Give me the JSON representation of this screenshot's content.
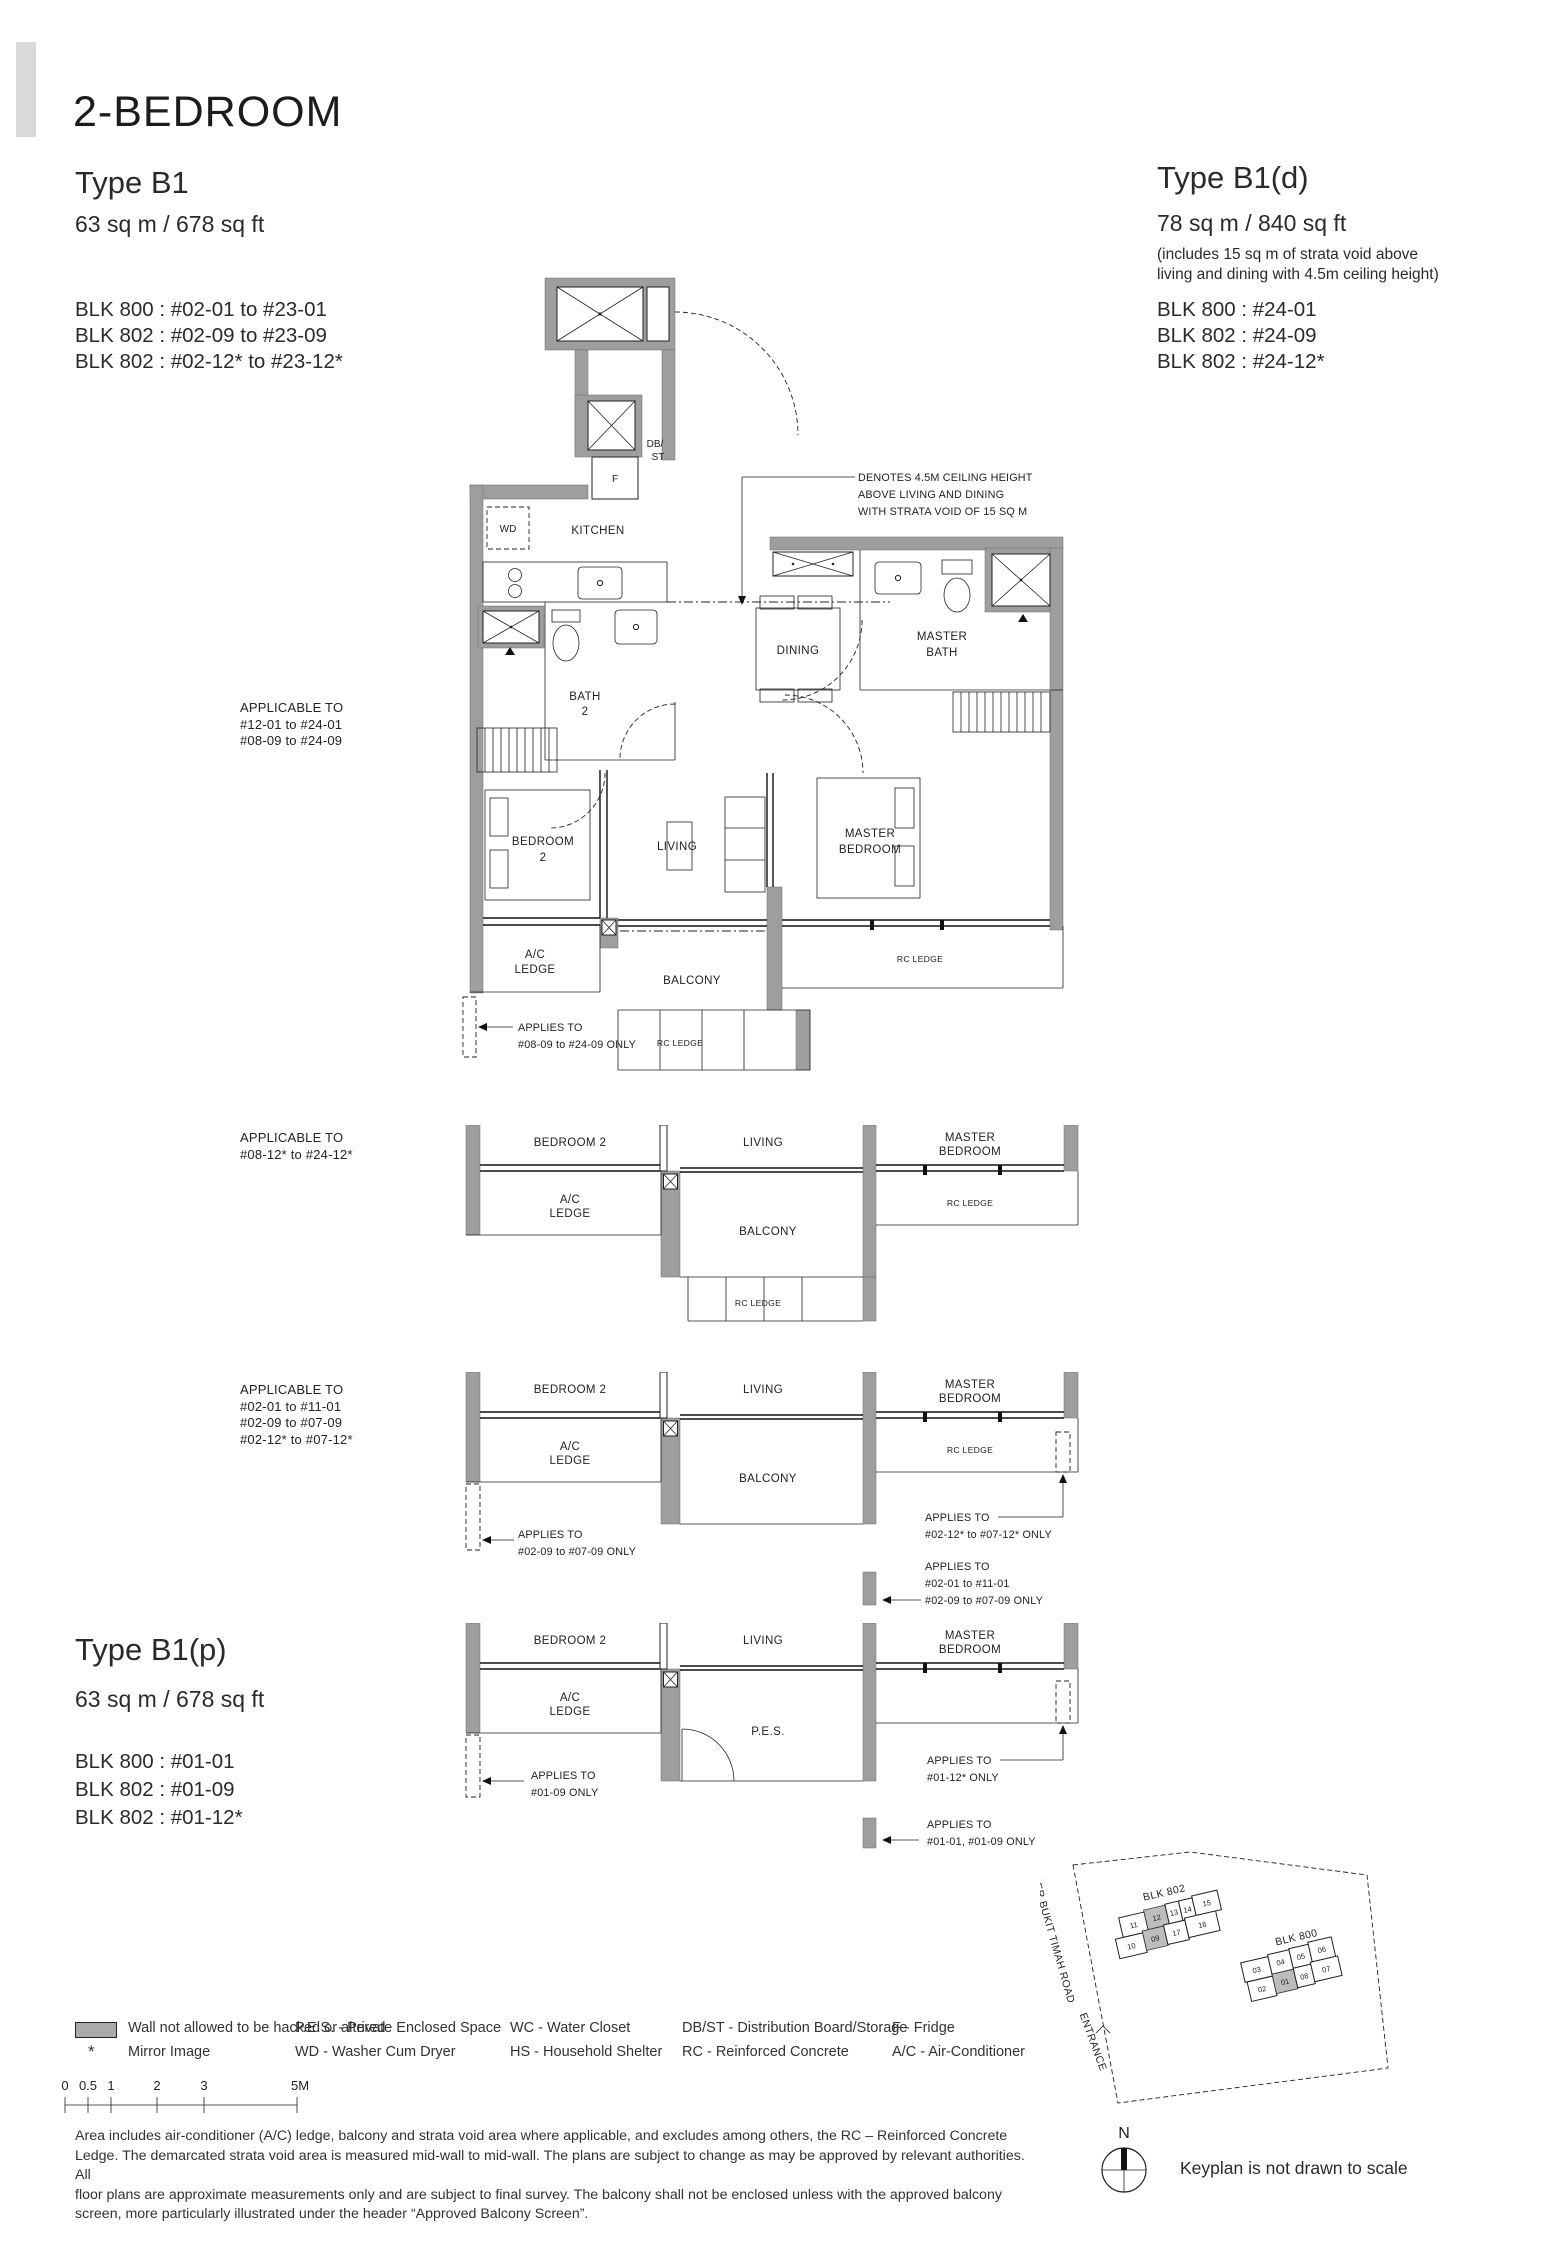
{
  "header": {
    "title": "2-BEDROOM"
  },
  "type_b1": {
    "name": "Type B1",
    "area": "63 sq m / 678 sq ft",
    "blocks": [
      "BLK 800 : #02-01 to #23-01",
      "BLK 802 : #02-09 to #23-09",
      "BLK 802 : #02-12* to #23-12*"
    ]
  },
  "type_b1d": {
    "name": "Type B1(d)",
    "area": "78 sq m / 840 sq ft",
    "note1": "(includes 15 sq m of strata void above",
    "note2": "living and dining with 4.5m ceiling height)",
    "blocks": [
      "BLK 800 : #24-01",
      "BLK 802 : #24-09",
      "BLK 802 : #24-12*"
    ]
  },
  "type_b1p": {
    "name": "Type B1(p)",
    "area": "63 sq m / 678 sq ft",
    "blocks": [
      "BLK 800 : #01-01",
      "BLK 802 : #01-09",
      "BLK 802 : #01-12*"
    ]
  },
  "rooms": {
    "kitchen": "KITCHEN",
    "dining": "DINING",
    "living": "LIVING",
    "bedroom2": "BEDROOM 2",
    "bedroom2_l1": "BEDROOM",
    "bedroom2_l2": "2",
    "master_l1": "MASTER",
    "master_l2": "BEDROOM",
    "masterbath_l1": "MASTER",
    "masterbath_l2": "BATH",
    "bath2_l1": "BATH",
    "bath2_l2": "2",
    "wd": "WD",
    "f": "F",
    "db1": "DB/",
    "db2": "ST",
    "ac1": "A/C",
    "ac2": "LEDGE",
    "balcony": "BALCONY",
    "rc": "RC LEDGE",
    "pes": "P.E.S."
  },
  "plan1": {
    "applicable": [
      "APPLICABLE TO",
      "#12-01 to #24-01",
      "#08-09 to #24-09"
    ],
    "ceiling_note": [
      "DENOTES 4.5M CEILING HEIGHT",
      "ABOVE LIVING AND DINING",
      "WITH STRATA VOID OF 15 SQ M"
    ],
    "note_left": [
      "APPLIES TO",
      "#08-09 to #24-09 ONLY"
    ]
  },
  "plan2": {
    "applicable": [
      "APPLICABLE TO",
      "#08-12* to #24-12*"
    ]
  },
  "plan3": {
    "applicable": [
      "APPLICABLE TO",
      "#02-01 to #11-01",
      "#02-09 to #07-09",
      "#02-12* to #07-12*"
    ],
    "note_left": [
      "APPLIES TO",
      "#02-09 to #07-09 ONLY"
    ],
    "note_r1": [
      "APPLIES TO",
      "#02-12* to #07-12* ONLY"
    ],
    "note_r2": [
      "APPLIES TO",
      "#02-01 to #11-01",
      "#02-09 to #07-09 ONLY"
    ]
  },
  "plan4": {
    "note_left": [
      "APPLIES TO",
      "#01-09 ONLY"
    ],
    "note_r1": [
      "APPLIES TO",
      "#01-12* ONLY"
    ],
    "note_r2": [
      "APPLIES TO",
      "#01-01, #01-09 ONLY"
    ]
  },
  "legend": {
    "wall": "Wall not allowed to be hacked or altered",
    "mirror_sym": "*",
    "mirror": "Mirror Image",
    "col2": [
      "P.E.S. - Private Enclosed Space",
      "WD - Washer Cum Dryer"
    ],
    "col3": [
      "WC - Water Closet",
      "HS - Household Shelter"
    ],
    "col4": [
      "DB/ST - Distribution Board/Storage",
      "RC - Reinforced Concrete"
    ],
    "col5": [
      "F - Fridge",
      "A/C - Air-Conditioner"
    ]
  },
  "scalebar": {
    "labels": [
      "0",
      "0.5",
      "1",
      "2",
      "3",
      "5M"
    ]
  },
  "disclaimer": {
    "lines": [
      "Area includes air-conditioner (A/C) ledge, balcony and strata void area where applicable, and excludes among others, the RC – Reinforced Concrete",
      "Ledge. The demarcated strata void area is measured mid-wall to mid-wall. The plans are subject to change as may be approved by relevant authorities. All",
      "floor plans are approximate measurements only and are subject to final survey. The balcony shall not be enclosed unless with the approved balcony",
      "screen, more particularly illustrated under the header “Approved Balcony Screen”."
    ]
  },
  "keyplan": {
    "blk802": "BLK 802",
    "blk800": "BLK 800",
    "road": "UPPER BUKIT TIMAH ROAD",
    "entrance": "ENTRANCE",
    "units_802_top": [
      "11",
      "12",
      "13",
      "14",
      "15"
    ],
    "units_802_bot": [
      "10",
      "09",
      "17",
      "16"
    ],
    "units_800_top": [
      "03",
      "04",
      "05",
      "06"
    ],
    "units_800_bot": [
      "02",
      "01",
      "08",
      "07"
    ],
    "north": "N",
    "note": "Keyplan is not drawn to scale"
  }
}
